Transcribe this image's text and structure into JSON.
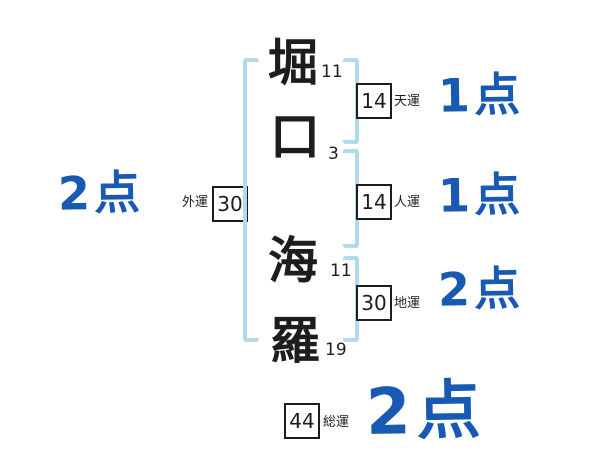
{
  "diagram_type": "japanese-name-fortune-chart",
  "name": {
    "chars": [
      {
        "char": "堀",
        "strokes": "11"
      },
      {
        "char": "口",
        "strokes": "3"
      },
      {
        "char": "海",
        "strokes": "11"
      },
      {
        "char": "羅",
        "strokes": "19"
      }
    ]
  },
  "fortunes": [
    {
      "id": "gaiun",
      "label": "外運",
      "value": "30",
      "score": "2点"
    },
    {
      "id": "tenun",
      "label": "天運",
      "value": "14",
      "score": "1点"
    },
    {
      "id": "jinun",
      "label": "人運",
      "value": "14",
      "score": "1点"
    },
    {
      "id": "chiun",
      "label": "地運",
      "value": "30",
      "score": "2点"
    },
    {
      "id": "souun",
      "label": "総運",
      "value": "44",
      "score": "2点"
    }
  ],
  "colors": {
    "score_blue": "#1759b3",
    "bracket_light_blue": "#aedcee",
    "ink_black": "#1d1d1d",
    "background": "#ffffff"
  }
}
